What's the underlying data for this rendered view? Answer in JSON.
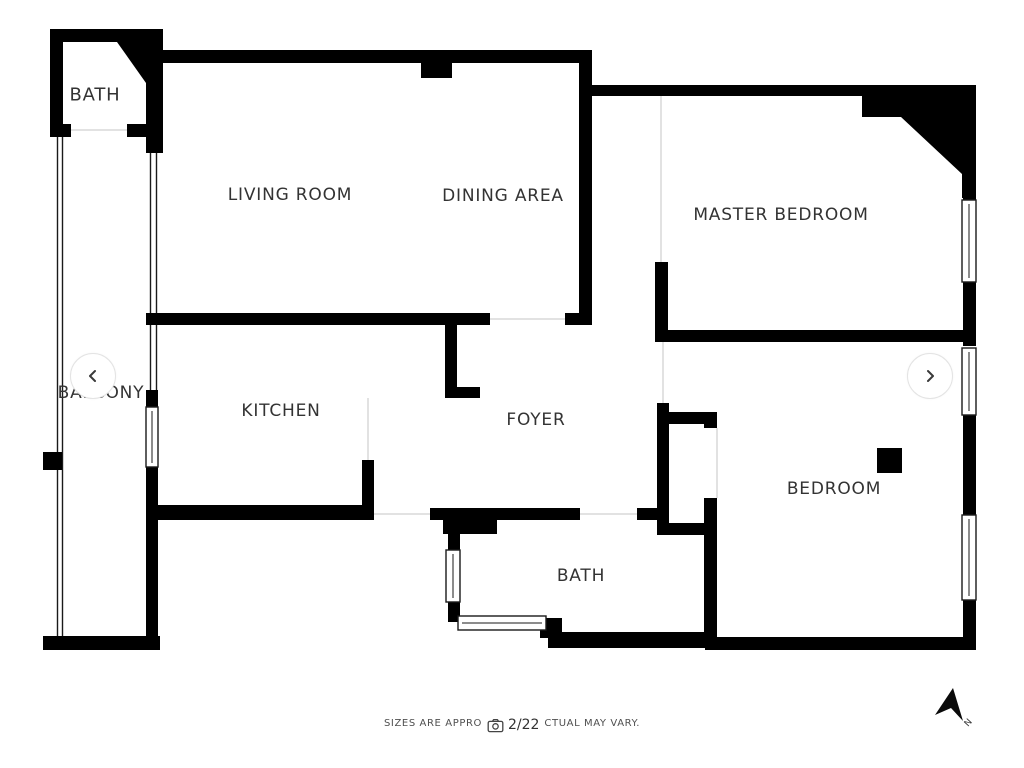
{
  "floorplan": {
    "rooms": [
      {
        "id": "bath-top",
        "label": "BATH"
      },
      {
        "id": "living-room",
        "label": "LIVING ROOM"
      },
      {
        "id": "dining-area",
        "label": "DINING AREA"
      },
      {
        "id": "master-bedroom",
        "label": "MASTER BEDROOM"
      },
      {
        "id": "balcony",
        "label": "BALCONY"
      },
      {
        "id": "kitchen",
        "label": "KITCHEN"
      },
      {
        "id": "foyer",
        "label": "FOYER"
      },
      {
        "id": "bedroom",
        "label": "BEDROOM"
      },
      {
        "id": "bath-bottom",
        "label": "BATH"
      }
    ],
    "colors": {
      "wall": "#000000",
      "label": "#333333",
      "door_guide": "#d9d9d9",
      "footer_text": "#4f4f4f"
    }
  },
  "carousel": {
    "counter": "2/22",
    "icons": {
      "prev": "chevron-left",
      "next": "chevron-right",
      "counter_camera": "camera"
    }
  },
  "footer": {
    "disclaimer_visible_left": "SIZES ARE APPRO",
    "disclaimer_visible_right": "CTUAL MAY VARY."
  },
  "compass": {
    "north_label": "N",
    "icon": "north-arrow"
  }
}
